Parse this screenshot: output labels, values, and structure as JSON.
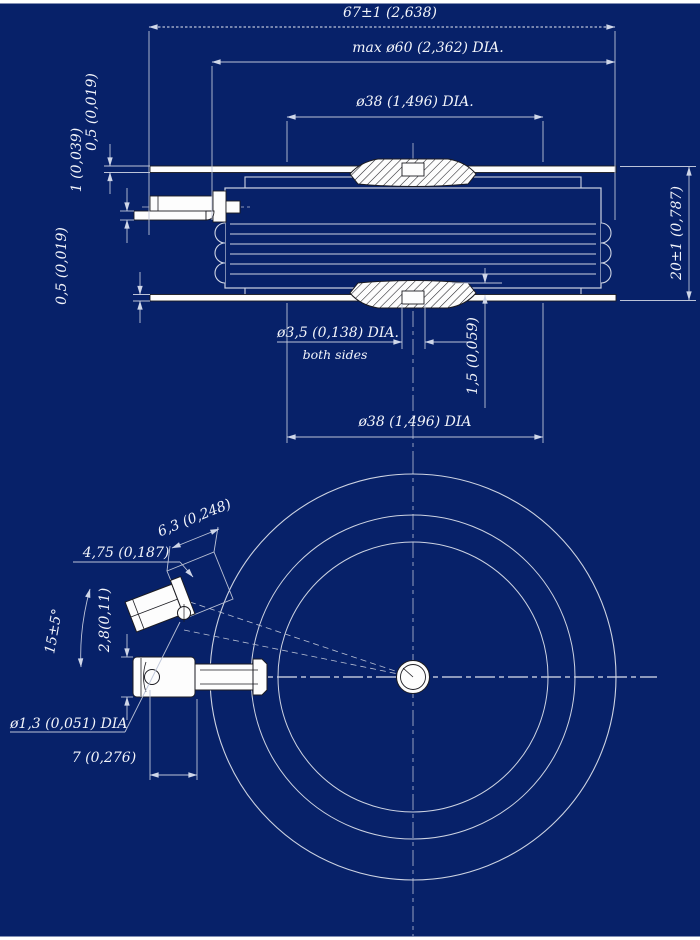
{
  "colors": {
    "background": "#072169",
    "object_line": "#cdd3e2",
    "part_fill": "#fdfdfd",
    "part_outline": "#1c1c22",
    "dim_line": "#bcc3d8",
    "text": "#f2f4fa"
  },
  "dims": {
    "width_total": "67±1 (2,638)",
    "dia_max": "max ø60 (2,362) DIA.",
    "dia_contact_top": "ø38 (1,496) DIA.",
    "plate_top_thickness": "0,5 (0,019)",
    "lead_thickness": "1 (0,039)",
    "plate_bottom_thickness": "0,5 (0,019)",
    "height": "20±1 (0,787)",
    "recess_dia": "ø3,5 (0,138) DIA.",
    "recess_note": "both sides",
    "recess_depth": "1,5 (0,059)",
    "dia_contact_bottom": "ø38 (1,496) DIA",
    "tab_width": "4,75 (0,187)",
    "tab_length": "6,3 (0,248)",
    "gate_angle": "15±5°",
    "terminal_width": "2,8(0,11)",
    "hole_dia": "ø1,3 (0,051) DIA",
    "hole_offset": "7 (0,276)"
  }
}
